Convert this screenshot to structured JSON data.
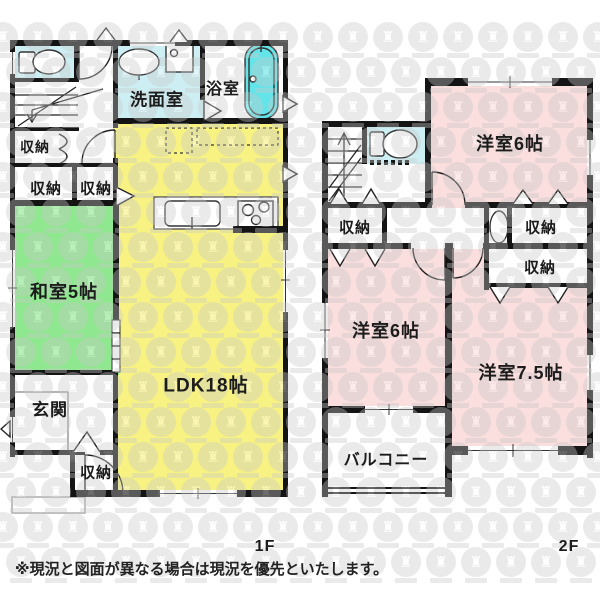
{
  "note": "※現況と図面が異なる場合は現況を優先といたします。",
  "floors": {
    "f1": "1F",
    "f2": "2F"
  },
  "colors": {
    "wall": "#141414",
    "ldk": "#f7f282",
    "tatami": "#8fe78f",
    "western": "#fbdede",
    "wet": "#cdeff4",
    "tub": "#63e4e8",
    "watermark": "#c9c9c9"
  },
  "watermark_badge_glyph": "♜",
  "floor1": {
    "rooms": {
      "washroom": "洗面室",
      "bath": "浴室",
      "storage1": "収納",
      "storage2": "収納",
      "storage3": "収納",
      "japanese_room": "和室5帖",
      "ldk": "LDK18帖",
      "entrance": "玄関",
      "storage4": "収納"
    }
  },
  "floor2": {
    "rooms": {
      "western6_top": "洋室6帖",
      "storage_left": "収納",
      "storage_right_top": "収納",
      "storage_right_bottom": "収納",
      "western6_bottom": "洋室6帖",
      "western75": "洋室7.5帖",
      "balcony": "バルコニー"
    }
  }
}
